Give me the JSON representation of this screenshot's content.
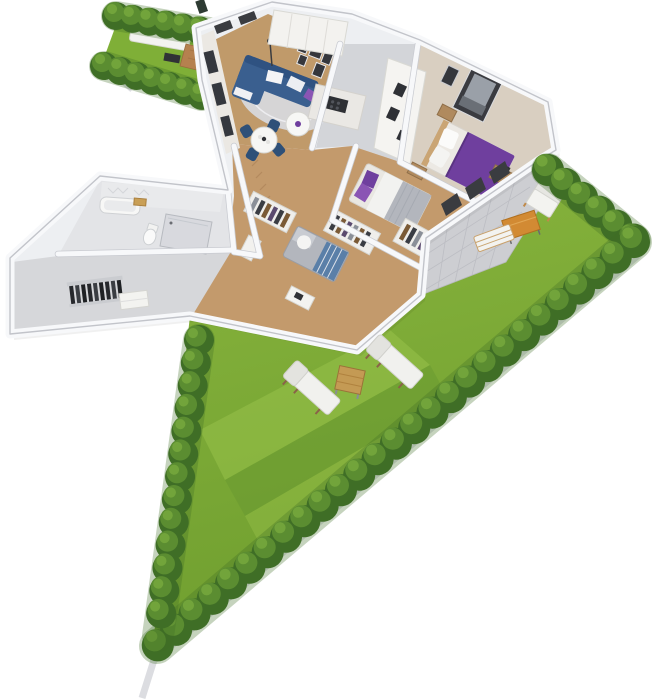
{
  "scene": {
    "kind": "3d-floor-plan-render",
    "description": "Isometric 3D cutaway floor plan of an apartment with surrounding triangular garden, hedges, terrace and sun loungers",
    "background": "#ffffff"
  },
  "colors": {
    "background": "#ffffff",
    "grass": "#7faf37",
    "grassLight": "#9ac34c",
    "grassDark": "#679631",
    "hedgeDark": "#3f6e26",
    "hedgeMid": "#5b8d31",
    "hedgeLight": "#74a53c",
    "sidewalk": "#dcdde1",
    "wallFill": "#edeff2",
    "wallTop": "#f7f8fa",
    "wallEdge": "#c2c4ca",
    "shadow": "#000000",
    "woodFloor": "#c09a6a",
    "hallFloor": "#c39a6c",
    "kitchenFloor": "#d3d5d9",
    "bedroomFloor": "#d9cfc1",
    "tileFloor": "#e3e4e7",
    "entryFloor": "#d6d7da",
    "terrace": "#cdced2",
    "sofaBlue": "#3a5f8f",
    "chairNavy": "#2e5078",
    "bedPurple": "#6f3f9e",
    "accentPurple": "#8a55b4",
    "grayFabric": "#b3b6bd",
    "tableOrange": "#d28a33",
    "deckWood": "#b5814f",
    "gardenTableWood": "#c49a54",
    "furnitureWhite": "#f3f3f0",
    "darkAccent": "#303236",
    "woodBrown": "#b08a5e",
    "rug": "#d8dbe2"
  },
  "rooms": [
    {
      "name": "living-room",
      "furniture": [
        "corner-sofa",
        "coffee-table",
        "dining-table",
        "dining-chairs",
        "rug",
        "wall-art",
        "curtain-wall",
        "floor-lamp"
      ]
    },
    {
      "name": "kitchen",
      "furniture": [
        "upper-cabinets",
        "counter-with-cooktop",
        "tall-shelf-unit"
      ]
    },
    {
      "name": "master-bedroom",
      "furniture": [
        "double-bed-purple",
        "nightstands",
        "wall-art",
        "dresser",
        "dark-wardrobe"
      ]
    },
    {
      "name": "second-bedroom",
      "furniture": [
        "single-bed",
        "clothes-racks"
      ]
    },
    {
      "name": "office-room",
      "furniture": [
        "daybed",
        "desk",
        "clothes-rack",
        "cabinet"
      ]
    },
    {
      "name": "bathroom",
      "furniture": [
        "bathtub",
        "toilet",
        "shower",
        "wood-shelf"
      ]
    },
    {
      "name": "entry-hall",
      "furniture": [
        "coat-rack",
        "dresser"
      ]
    }
  ],
  "garden": {
    "areas": [
      "triangular-lawn",
      "side-garden-strip",
      "terrace"
    ],
    "objects": [
      "hedge-rows",
      "sidewalk",
      "sun-lounger",
      "sun-lounger",
      "garden-table",
      "outdoor-armchair",
      "outdoor-coffee-table",
      "outdoor-bench",
      "patio-sofa",
      "wood-deck",
      "grill-table"
    ]
  }
}
